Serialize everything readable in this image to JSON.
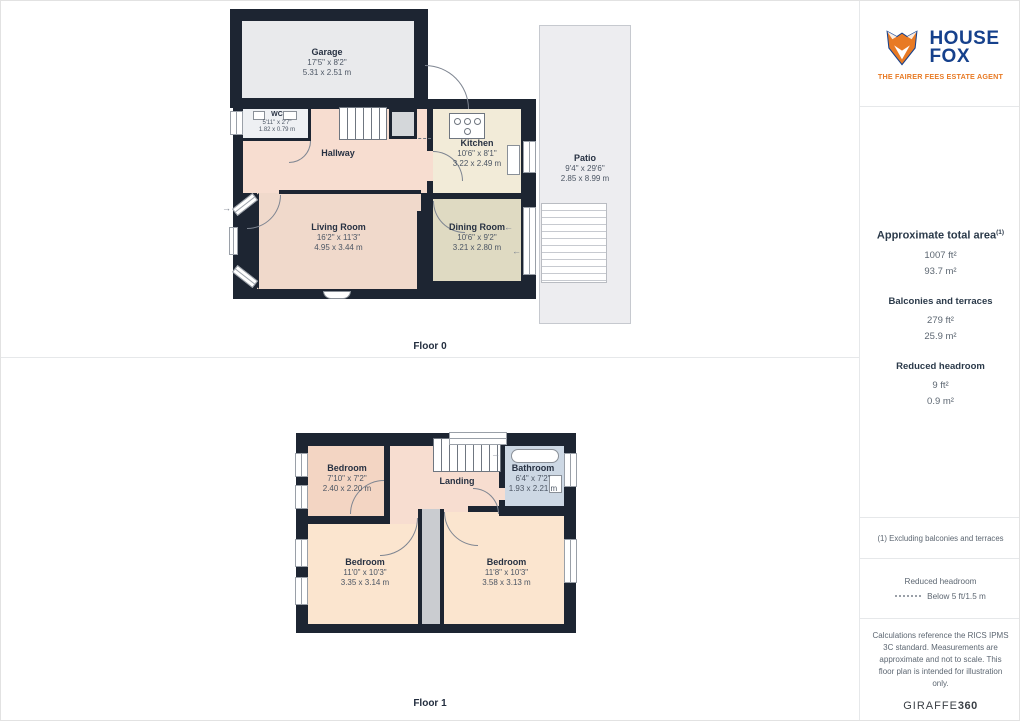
{
  "sidebar": {
    "logo": {
      "name_line1": "HOUSE",
      "name_line2": "FOX",
      "tagline": "THE FAIRER FEES ESTATE AGENT"
    },
    "summary": {
      "total": {
        "label": "Approximate total area",
        "sup": "(1)",
        "imperial": "1007 ft²",
        "metric": "93.7 m²"
      },
      "balconies": {
        "label": "Balconies and terraces",
        "imperial": "279 ft²",
        "metric": "25.9 m²"
      },
      "reduced": {
        "label": "Reduced headroom",
        "imperial": "9 ft²",
        "metric": "0.9 m²"
      }
    },
    "footnote": "(1) Excluding balconies and terraces",
    "legend": {
      "title": "Reduced headroom",
      "entry": "Below 5 ft/1.5 m"
    },
    "disclaimer": "Calculations reference the RICS IPMS 3C standard. Measurements are approximate and not to scale. This floor plan is intended for illustration only.",
    "brand": {
      "name": "GIRAFFE",
      "suffix": "360"
    }
  },
  "floors": {
    "floor0": {
      "label": "Floor 0",
      "rooms": {
        "garage": {
          "name": "Garage",
          "imperial": "17'5\" x 8'2\"",
          "metric": "5.31 x 2.51 m"
        },
        "wc": {
          "name": "WC",
          "imperial": "5'11\" x 2'7\"",
          "metric": "1.82 x 0.79 m"
        },
        "hallway": {
          "name": "Hallway"
        },
        "kitchen": {
          "name": "Kitchen",
          "imperial": "10'6\" x 8'1\"",
          "metric": "3.22 x 2.49 m"
        },
        "living_room": {
          "name": "Living Room",
          "imperial": "16'2\" x 11'3\"",
          "metric": "4.95 x 3.44 m"
        },
        "dining_room": {
          "name": "Dining Room",
          "imperial": "10'6\" x 9'2\"",
          "metric": "3.21 x 2.80 m"
        },
        "patio": {
          "name": "Patio",
          "imperial": "9'4\" x 29'6\"",
          "metric": "2.85 x 8.99 m"
        }
      }
    },
    "floor1": {
      "label": "Floor 1",
      "rooms": {
        "bedroom_top": {
          "name": "Bedroom",
          "imperial": "7'10\" x 7'2\"",
          "metric": "2.40 x 2.20 m"
        },
        "landing": {
          "name": "Landing"
        },
        "bathroom": {
          "name": "Bathroom",
          "imperial": "6'4\" x 7'2\"",
          "metric": "1.93 x 2.21 m"
        },
        "bedroom_left": {
          "name": "Bedroom",
          "imperial": "11'0\" x 10'3\"",
          "metric": "3.35 x 3.14 m"
        },
        "bedroom_right": {
          "name": "Bedroom",
          "imperial": "11'8\" x 10'3\"",
          "metric": "3.58 x 3.13 m"
        }
      }
    }
  },
  "colors": {
    "wall": "#1d2532",
    "logo_blue": "#16418c",
    "logo_orange": "#e87a24",
    "patio_fill": "#ededf0",
    "hallway_fill": "#f7ddd0",
    "kitchen_fill": "#f2ebd8",
    "dining_fill": "#dfdac2",
    "bedroom_fill": "#fbe5cf",
    "bathroom_fill": "#cdd8e4"
  }
}
